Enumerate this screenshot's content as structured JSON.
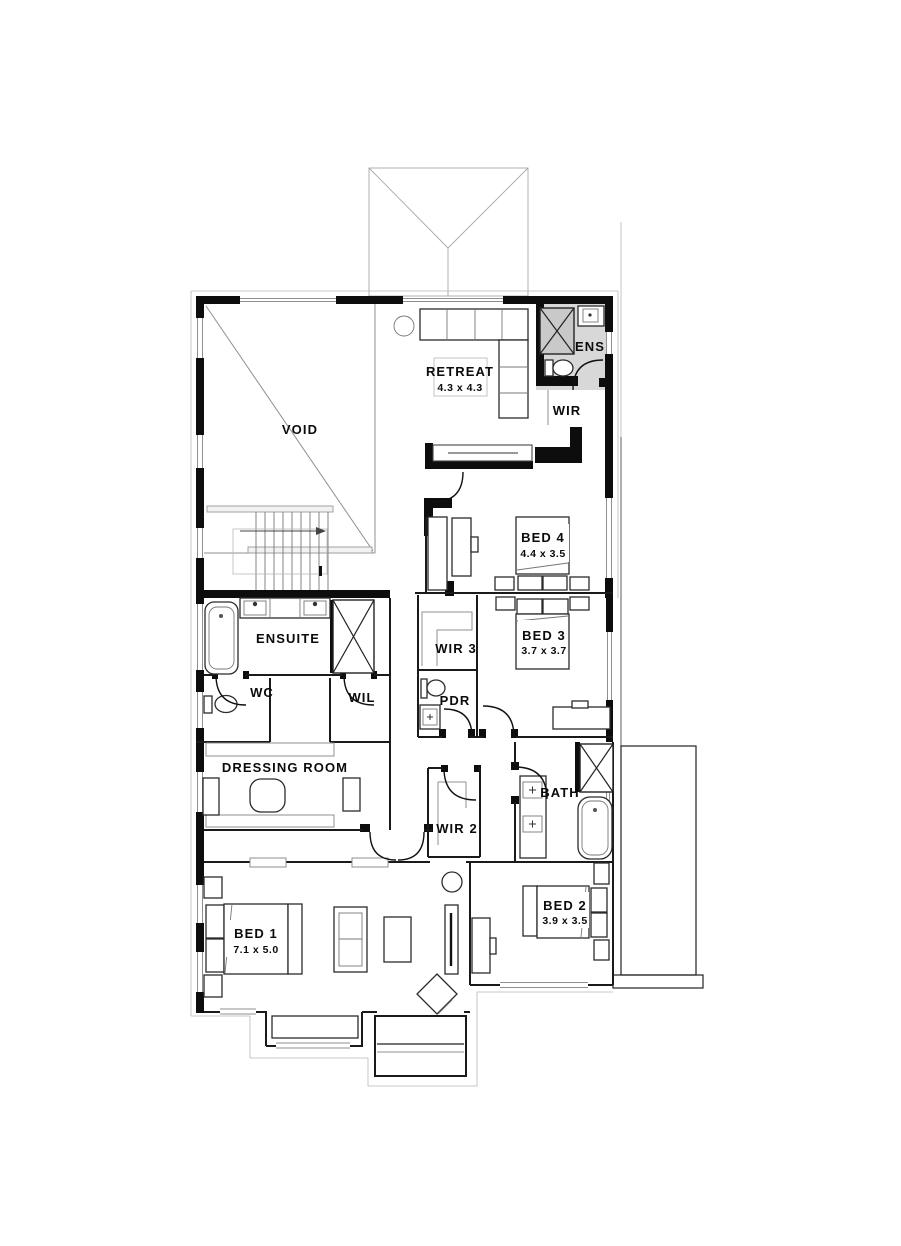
{
  "drawing": {
    "kind": "residential upper floor plan",
    "stair_direction": "up"
  },
  "colors": {
    "bg": "#ffffff",
    "wall": "#0d0d0d",
    "line": "#1a1a1a",
    "thin_line": "#8f8f8f",
    "ens_floor": "#d8d8d8",
    "shower_floor": "#c9c9c9"
  },
  "rooms": [
    {
      "name": "VOID",
      "dims": ""
    },
    {
      "name": "RETREAT",
      "dims": "4.3 x 4.3"
    },
    {
      "name": "ENS",
      "dims": ""
    },
    {
      "name": "WIR",
      "dims": ""
    },
    {
      "name": "BED 4",
      "dims": "4.4 x 3.5"
    },
    {
      "name": "ENSUITE",
      "dims": ""
    },
    {
      "name": "WC",
      "dims": ""
    },
    {
      "name": "WIL",
      "dims": ""
    },
    {
      "name": "WIR 3",
      "dims": ""
    },
    {
      "name": "BED 3",
      "dims": "3.7 x 3.7"
    },
    {
      "name": "PDR",
      "dims": ""
    },
    {
      "name": "DRESSING ROOM",
      "dims": ""
    },
    {
      "name": "BATH",
      "dims": ""
    },
    {
      "name": "WIR 2",
      "dims": ""
    },
    {
      "name": "BED 1",
      "dims": "7.1 x 5.0"
    },
    {
      "name": "BED 2",
      "dims": "3.9 x 3.5"
    }
  ]
}
